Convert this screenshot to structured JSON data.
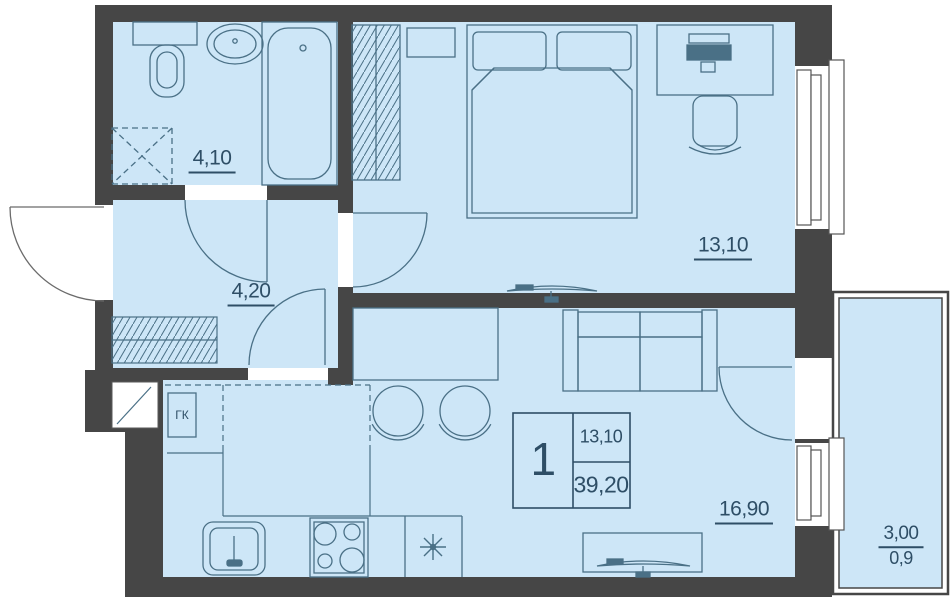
{
  "plan": {
    "rooms": {
      "bathroom": {
        "area": "4,10"
      },
      "hallway": {
        "area": "4,20"
      },
      "bedroom": {
        "area": "13,10"
      },
      "living_kitchen": {
        "area": "16,90"
      },
      "balcony": {
        "area": "3,00",
        "area_coeff": "0,9"
      }
    },
    "info_box": {
      "apartment_number": "1",
      "living_area": "13,10",
      "total_area": "39,20"
    },
    "labels": {
      "gas_boiler": "ГК"
    },
    "colors": {
      "wall": "#464646",
      "floor_fill": "#cde6f7",
      "furniture_line": "#4a7086",
      "text": "#2e4e66",
      "background": "#ffffff"
    }
  }
}
